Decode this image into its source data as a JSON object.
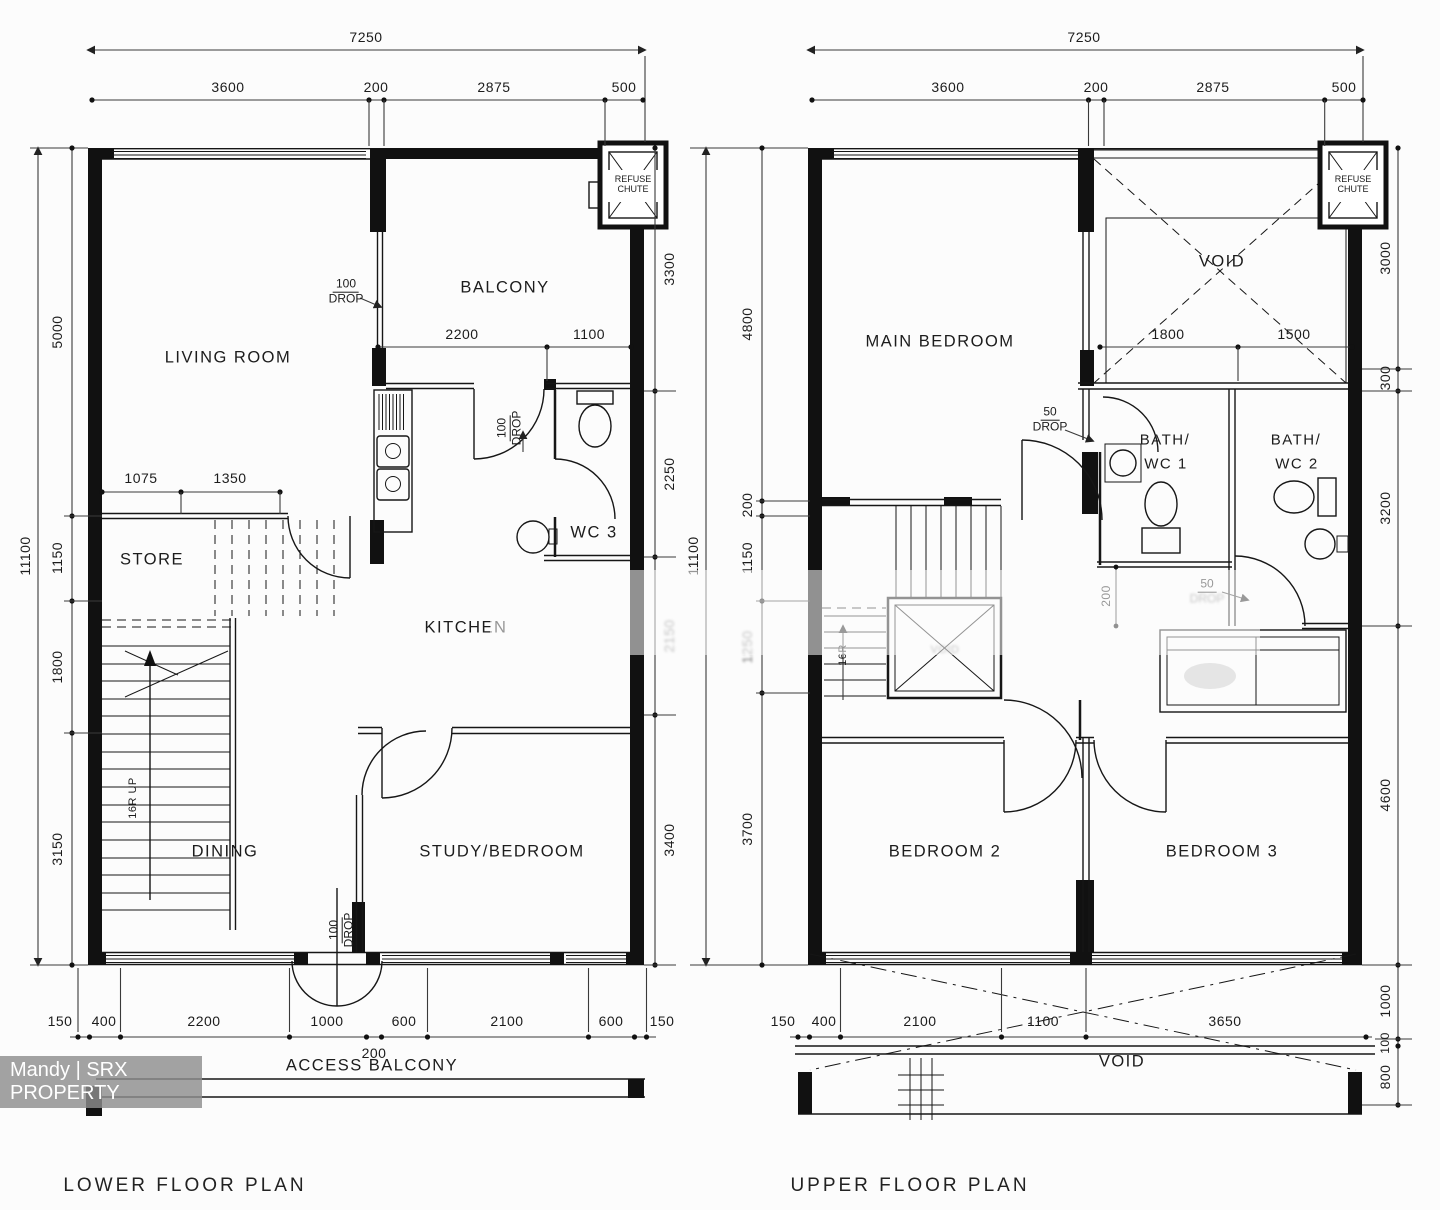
{
  "watermark": {
    "text": "Mandy | SRX PROPERTY"
  },
  "titles": {
    "lower": "LOWER FLOOR PLAN",
    "upper": "UPPER FLOOR PLAN"
  },
  "chute_label": "REFUSE CHUTE",
  "lower": {
    "rooms": {
      "living": "LIVING ROOM",
      "balcony": "BALCONY",
      "store": "STORE",
      "kitchen": "KITCHEN",
      "wc3": "WC 3",
      "dining": "DINING",
      "study": "STUDY/BEDROOM",
      "access": "ACCESS BALCONY"
    },
    "stairs": "16R UP",
    "drops": {
      "balcony": {
        "num": "100",
        "word": "DROP"
      },
      "kitchen": {
        "num": "100",
        "word": "DROP"
      },
      "door": {
        "num": "100",
        "word": "DROP"
      }
    },
    "dims": {
      "top": {
        "overall": "7250",
        "segs": [
          "3600",
          "200",
          "2875",
          "500"
        ]
      },
      "left": {
        "overall": "11100",
        "segs": [
          "5000",
          "1150",
          "1800",
          "3150"
        ]
      },
      "right": {
        "segs": [
          "3300",
          "2250",
          "2150",
          "3400"
        ]
      },
      "bottom": {
        "segs": [
          "150",
          "400",
          "2200",
          "1000",
          "600",
          "2100",
          "600",
          "150"
        ],
        "sub": "200"
      },
      "store": [
        "1075",
        "1350"
      ],
      "balcony": [
        "2200",
        "1100"
      ]
    }
  },
  "upper": {
    "rooms": {
      "main": "MAIN BEDROOM",
      "bed2": "BEDROOM 2",
      "bed3": "BEDROOM 3"
    },
    "baths": {
      "b1": {
        "l1": "BATH/",
        "l2": "WC 1"
      },
      "b2": {
        "l1": "BATH/",
        "l2": "WC 2"
      }
    },
    "voids": {
      "top": "VOID",
      "stair": "VOID",
      "bottom": "VOID"
    },
    "stairs": "16R",
    "drops": {
      "bath1": {
        "num": "50",
        "word": "DROP"
      },
      "corridor": {
        "num": "50",
        "word": "DROP"
      }
    },
    "dims": {
      "top": {
        "overall": "7250",
        "segs": [
          "3600",
          "200",
          "2875",
          "500"
        ]
      },
      "left": {
        "overall": "11100",
        "segs": [
          "4800",
          "200",
          "1150",
          "1250",
          "3700"
        ]
      },
      "right": {
        "segs": [
          "3000",
          "300",
          "3200",
          "4600",
          "1000",
          "100",
          "800"
        ]
      },
      "bottom": {
        "segs": [
          "150",
          "400",
          "2100",
          "1100",
          "3650"
        ]
      },
      "void": [
        "1800",
        "1500"
      ],
      "corridor": "200"
    }
  }
}
